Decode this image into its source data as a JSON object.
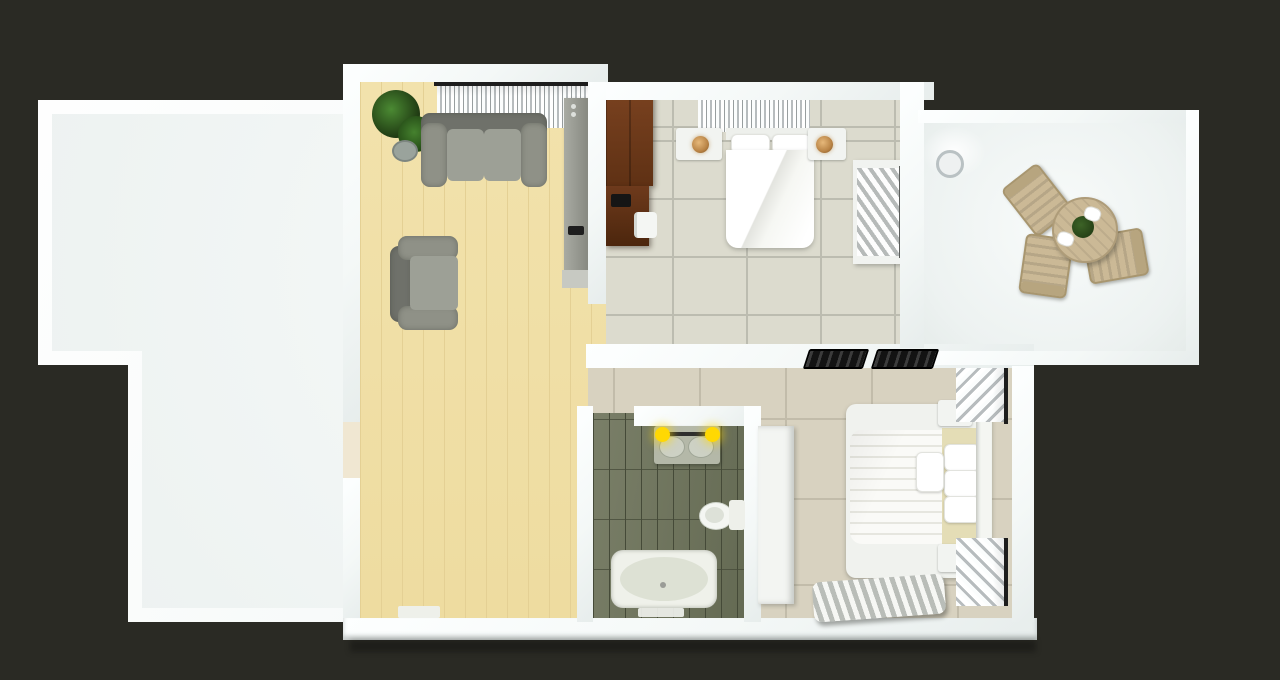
{
  "scene": {
    "description": "Top-down 3D architectural render of a small apartment floor plan on a dark background",
    "view": "top-down",
    "style": "3d-render",
    "visible_text": "none"
  },
  "colors": {
    "bg": "#2a2a24",
    "wall": "#f4f8f7",
    "terrace-floor": "#edf2f1",
    "wood": "#f2e2ac",
    "wood-line": "#e4d094",
    "tile": "#dcdbce",
    "tile-grout": "#bcbcb0",
    "tile2": "#d8d2c0",
    "tile2-grout": "#c2bcaa",
    "bath-tile-a": "#7a7f68",
    "bath-tile-b": "#646a53",
    "bath-grout": "#454a38",
    "sofa": "#8f9187",
    "sofa-dark": "#6f716a",
    "sofa-light": "#9da096",
    "dark-wood": "#5f3114",
    "dark-wood-deep": "#4c260d",
    "tan": "#cbb996",
    "tan-mattress": "#e4ddb6",
    "lamp-amber": "#b98446",
    "light-yellow": "#ffd803",
    "curtain-light": "#fbfdfd",
    "curtain-dark": "#b7bcbe",
    "vent-black": "#131313",
    "plant-green": "#3d7427",
    "plant-green-dark": "#1c3410",
    "white-object": "#f2f4f1"
  },
  "rooms": [
    {
      "id": "terrace-left",
      "type": "patio",
      "floor": "white-concrete",
      "furniture": []
    },
    {
      "id": "living-room",
      "type": "living",
      "floor": "light-wood",
      "furniture": [
        "potted-plant",
        "two-seat-sofa",
        "armchair",
        "media-cabinet",
        "window-curtain",
        "doormat"
      ]
    },
    {
      "id": "bedroom-top",
      "type": "bedroom",
      "floor": "ceramic-tile",
      "furniture": [
        "wood-wardrobe",
        "desk",
        "laptop",
        "desk-chair",
        "double-bed",
        "nightstand-left",
        "nightstand-right",
        "bedside-lamps",
        "window-curtain",
        "open-wardrobe-with-clothes"
      ]
    },
    {
      "id": "hallway",
      "type": "hall",
      "floor": "ceramic-tile",
      "furniture": []
    },
    {
      "id": "bathroom",
      "type": "bathroom",
      "floor": "green-plank-tile",
      "furniture": [
        "vanity-sink",
        "vanity-lights",
        "toilet",
        "bathtub",
        "bathmat"
      ]
    },
    {
      "id": "bedroom-bottom",
      "type": "bedroom",
      "floor": "ceramic-tile",
      "furniture": [
        "double-bed",
        "quilted-duvet",
        "pillows",
        "headboard",
        "nightstand-top",
        "nightstand-bottom",
        "window-curtains",
        "wardrobe",
        "slatted-rack"
      ]
    },
    {
      "id": "terrace-right",
      "type": "balcony",
      "floor": "white-concrete",
      "furniture": [
        "round-dining-table",
        "dining-chair",
        "dining-chair",
        "dining-chair",
        "plates",
        "plant-centerpiece",
        "white-potted-plant"
      ]
    }
  ],
  "fixtures": {
    "wall_vents": 2,
    "vanity_lights": 2,
    "bedside_lamps": 2,
    "doors": 2,
    "windows": 4
  }
}
